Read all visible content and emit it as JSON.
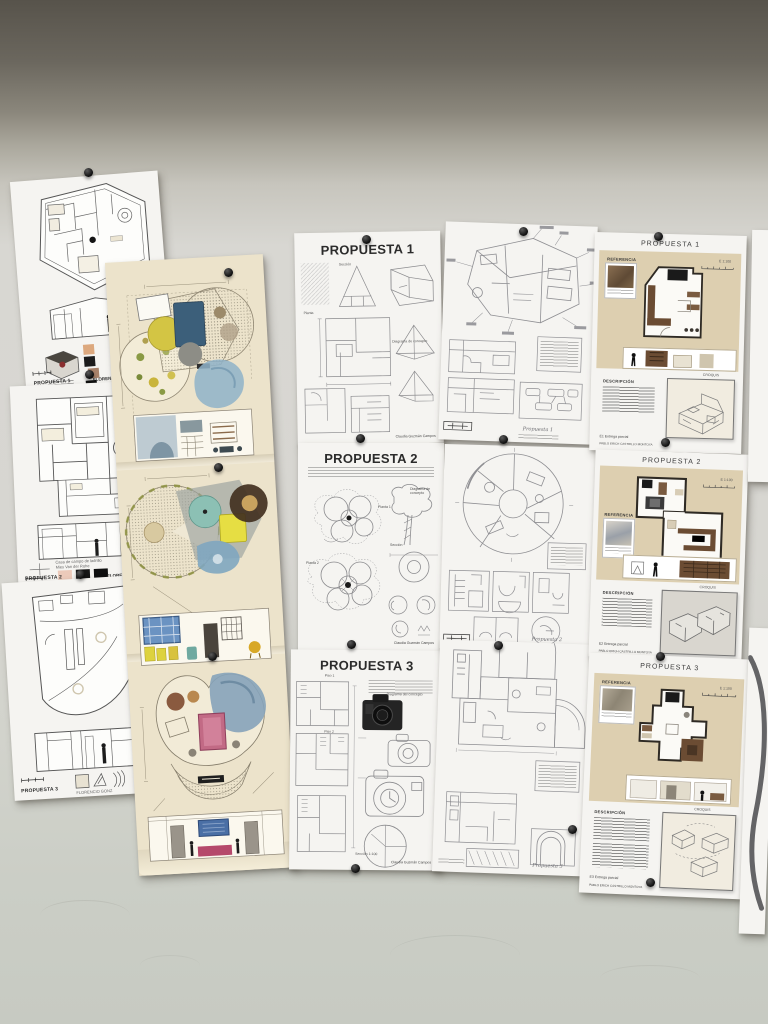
{
  "photo": {
    "kind": "photograph of an architecture-studio pin-up wall with student proposal sheets"
  },
  "left_column": {
    "sheets": [
      {
        "label": "PROPUESTA 1",
        "author": "FLORENCIO GONZÁLEZ, ESTELA",
        "swatches": [
          "#dca87e",
          "#1c1c1c",
          "#a8826a",
          "#111111"
        ]
      },
      {
        "label": "PROPUESTA 2",
        "author": "FLORENCIO GONZÁLEZ, ES",
        "caption1": "Casa de campo de ladrillo",
        "caption2": "Mies Van der Rohe",
        "swatches": [
          "#eccaba",
          "#161616",
          "#0f0f0f"
        ]
      },
      {
        "label": "PROPUESTA 3",
        "author": "FLORENCIO GONZ",
        "swatches": [
          "#d6ae8d",
          "#9c7b60"
        ]
      }
    ]
  },
  "sketch_column": {
    "sheets": [
      {
        "title": "PROPUESTA 1",
        "label_seccion": "Sección",
        "label_planta": "Planta",
        "label_diagrama": "Diagrama de concepto",
        "author": "Claudia Guzmán Campos"
      },
      {
        "title": "PROPUESTA 2",
        "label_planta1": "Planta 1",
        "label_planta2": "Planta 2",
        "label_seccion": "Sección",
        "label_diagrama": "Diagrama de concepto",
        "author": "Claudia Guzmán Campos"
      },
      {
        "title": "PROPUESTA 3",
        "label_piso1": "Piso 1",
        "label_piso2": "Piso 2",
        "label_seccion": "Sección 1:100",
        "label_diagrama": "Diagrama del concepto",
        "author": "Claudia Guzmán Campos"
      }
    ]
  },
  "handdrawn_column": {
    "sheets": [
      {
        "footer": "Propuesta 1"
      },
      {
        "footer": "Propuesta 2"
      },
      {
        "footer": "Propuesta 3"
      }
    ]
  },
  "poster_column": {
    "labels": {
      "referencia": "REFERENCIA",
      "croquis": "CROQUIS",
      "descripcion": "DESCRIPCIÓN",
      "scale": "E 1:100"
    },
    "sheets": [
      {
        "title": "PROPUESTA 1",
        "entrega": "E1  Entrega parcial",
        "author": "PABLO ERICH CASTRILLO MONTOYA"
      },
      {
        "title": "PROPUESTA 2",
        "entrega": "E2  Entrega parcial",
        "author": "PABLO ERICH CASTRILLO MONTOYA"
      },
      {
        "title": "PROPUESTA 3",
        "entrega": "E3  Entrega parcial",
        "author": "PABLO ERICH CASTRILLO MONTOYA"
      }
    ]
  }
}
